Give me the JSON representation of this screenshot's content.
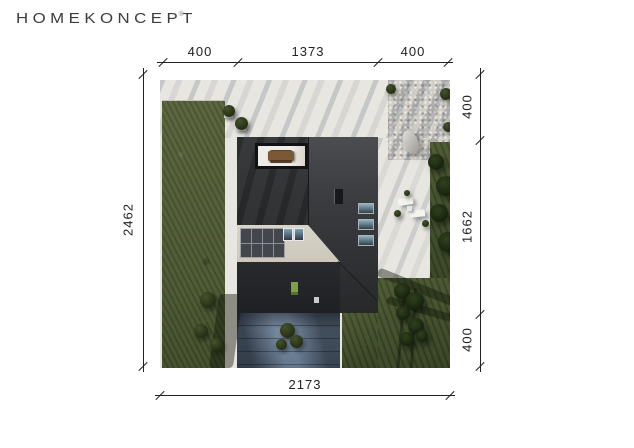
{
  "logo": {
    "text": "HOMEKONCEPT",
    "registered_mark": "®"
  },
  "dimensions": {
    "top": {
      "segments": [
        "400",
        "1373",
        "400"
      ]
    },
    "left": {
      "segments": [
        "2462"
      ]
    },
    "right": {
      "segments": [
        "400",
        "1662",
        "400"
      ]
    },
    "bottom": {
      "segments": [
        "2173"
      ]
    }
  },
  "site_view": {
    "description": "aerial top-down render of a modern dark flat-roof house on a landscaped plot",
    "features": [
      "lawn",
      "paved-terrace",
      "gravel-bed",
      "boulder",
      "driveway",
      "solar-panels",
      "roof-skylights",
      "roof-terrace-cutout",
      "outdoor-dining-table",
      "sun-loungers",
      "shrubs",
      "tree-shadows"
    ]
  },
  "palette": {
    "brand_text": "#3c3c3c",
    "dimension_lines": "#222222",
    "paving_light": "#e8e6e1",
    "gravel": "#d0cdc6",
    "lawn_green": "#566139",
    "lawn_dark": "#3d4a28",
    "roof_dark": "#2c2d2f",
    "roof_light_beige": "#d8d4c8",
    "driveway_blue_gray": "#72849a",
    "skylight_blue": "#7fa3b8",
    "solar_panel": "#43464c",
    "table_brown": "#7b5836",
    "door_green": "#7ba143"
  }
}
